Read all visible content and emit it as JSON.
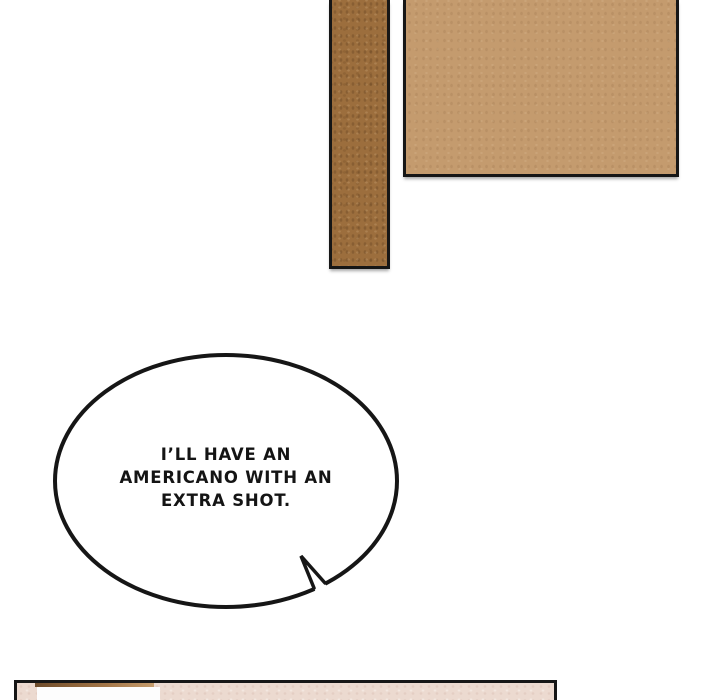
{
  "speech_bubble": {
    "lines": [
      "I’LL HAVE AN",
      "AMERICANO WITH AN",
      "EXTRA SHOT."
    ]
  },
  "colors": {
    "page_bg": "#ffffff",
    "outline": "#161616",
    "bubble_fill": "#ffffff",
    "beam_brown": "#9c6e3d",
    "board_tan": "#c49b6e",
    "panel_pink": "#ecdad0",
    "shelf_brown_dark": "#6e4c2c",
    "shelf_brown_light": "#c59c6d",
    "card_white": "#fdfdfd"
  }
}
